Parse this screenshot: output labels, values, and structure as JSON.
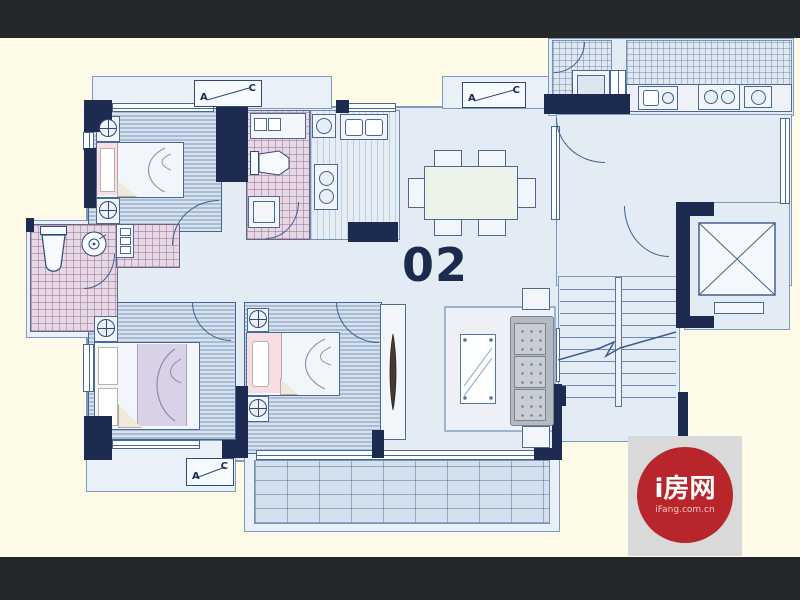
{
  "unit": {
    "number": "02"
  },
  "ac": {
    "a": "A",
    "c": "C"
  },
  "logo": {
    "title": "i房网",
    "domain": "iFang.com.cn"
  },
  "colors": {
    "letterbox": "#24282b",
    "background": "#fdfae8",
    "wall": "#1d2b50",
    "floor_plate": "#e3ebf5",
    "bedroom_floor": "#c2d3e5",
    "bathroom_tile": "#e6d8e4",
    "balcony_tile": "#d3e0ee",
    "unit_number_color": "#1c2a4e",
    "logo_red": "#b8262c",
    "logo_bg": "#d9d9d9"
  }
}
